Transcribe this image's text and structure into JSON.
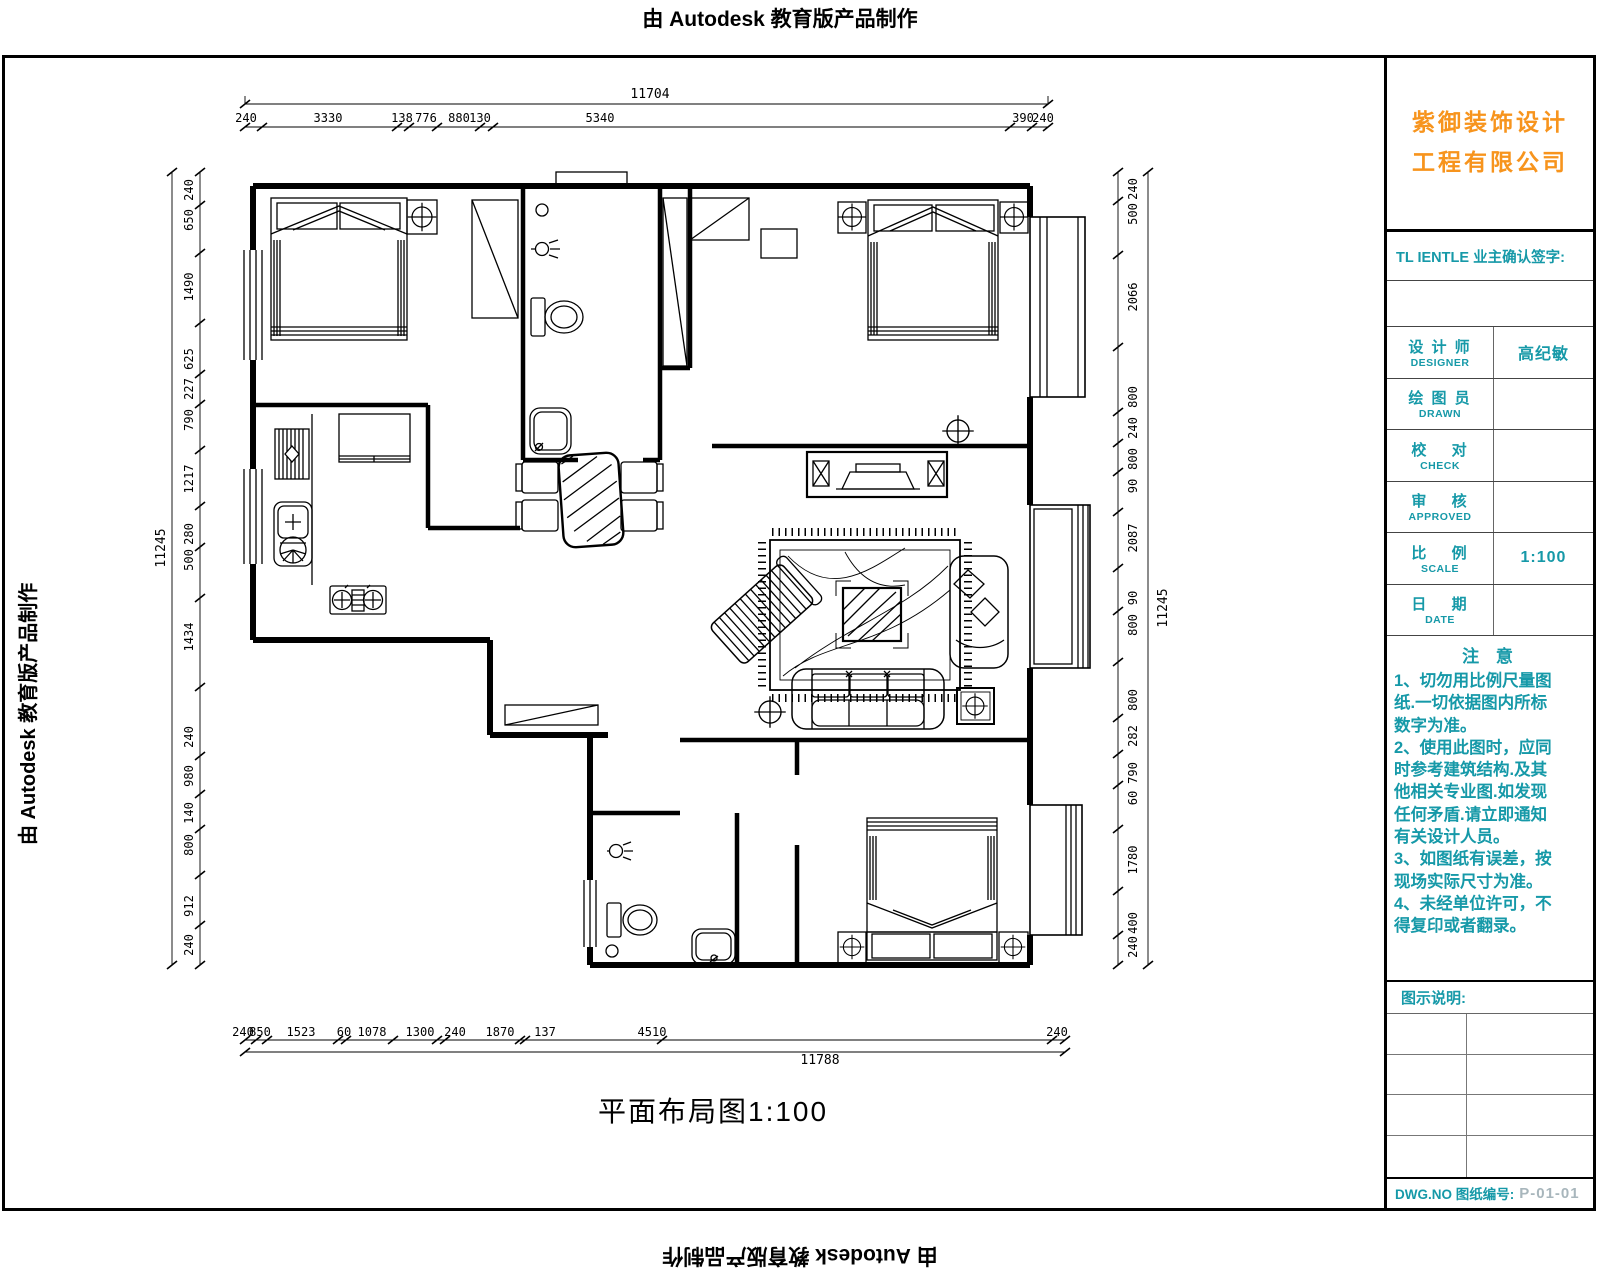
{
  "watermark": {
    "text": "由 Autodesk 教育版产品制作"
  },
  "plan_title": "平面布局图1:100",
  "titleblock": {
    "company_line1": "紫御装饰设计",
    "company_line2": "工程有限公司",
    "client_label": "TL IENTLE 业主确认签字:",
    "rows": [
      {
        "cn": "设 计 师",
        "en": "DESIGNER",
        "value": "高纪敏"
      },
      {
        "cn": "绘 图 员",
        "en": "DRAWN",
        "value": ""
      },
      {
        "cn": "校　 对",
        "en": "CHECK",
        "value": ""
      },
      {
        "cn": "审　 核",
        "en": "APPROVED",
        "value": ""
      },
      {
        "cn": "比　 例",
        "en": "SCALE",
        "value": "1:100"
      },
      {
        "cn": "日　 期",
        "en": "DATE",
        "value": ""
      }
    ],
    "notes_title": "注 意",
    "notes": "1、切勿用比例尺量图\n纸.一切依据图内所标\n数字为准。\n2、使用此图时，应同\n时参考建筑结构.及其\n他相关专业图.如发现\n任何矛盾.请立即通知\n有关设计人员。\n3、如图纸有误差，按\n现场实际尺寸为准。\n4、未经单位许可，不\n得复印或者翻录。",
    "legend_label": "图示说明:",
    "dwg_label": "DWG.NO 图纸编号:",
    "dwg_no": "P-01-01"
  },
  "dims": {
    "top": {
      "overall": "11704",
      "segments": [
        "240",
        "3330",
        "138",
        "776",
        "880",
        "130",
        "5340",
        "390",
        "240"
      ]
    },
    "bottom": {
      "overall": "11788",
      "segments": [
        "240",
        "850",
        "1523",
        "60",
        "1078",
        "1300",
        "240",
        "1870",
        "137",
        "4510",
        "240"
      ]
    },
    "left": {
      "overall": "11245",
      "segments": [
        "240",
        "650",
        "1490",
        "625",
        "227",
        "790",
        "1217",
        "280",
        "500",
        "1434",
        "240",
        "980",
        "140",
        "800",
        "912",
        "240"
      ]
    },
    "right": {
      "overall": "11245",
      "segments": [
        "240",
        "500",
        "2066",
        "800",
        "240",
        "800",
        "90",
        "2087",
        "90",
        "800",
        "800",
        "282",
        "790",
        "60",
        "1780",
        "400",
        "240"
      ]
    }
  },
  "colors": {
    "accent_orange": "#F7941D",
    "accent_teal": "#1699A8",
    "line_black": "#000000",
    "dwg_no_gray": "#A8B6BC"
  }
}
